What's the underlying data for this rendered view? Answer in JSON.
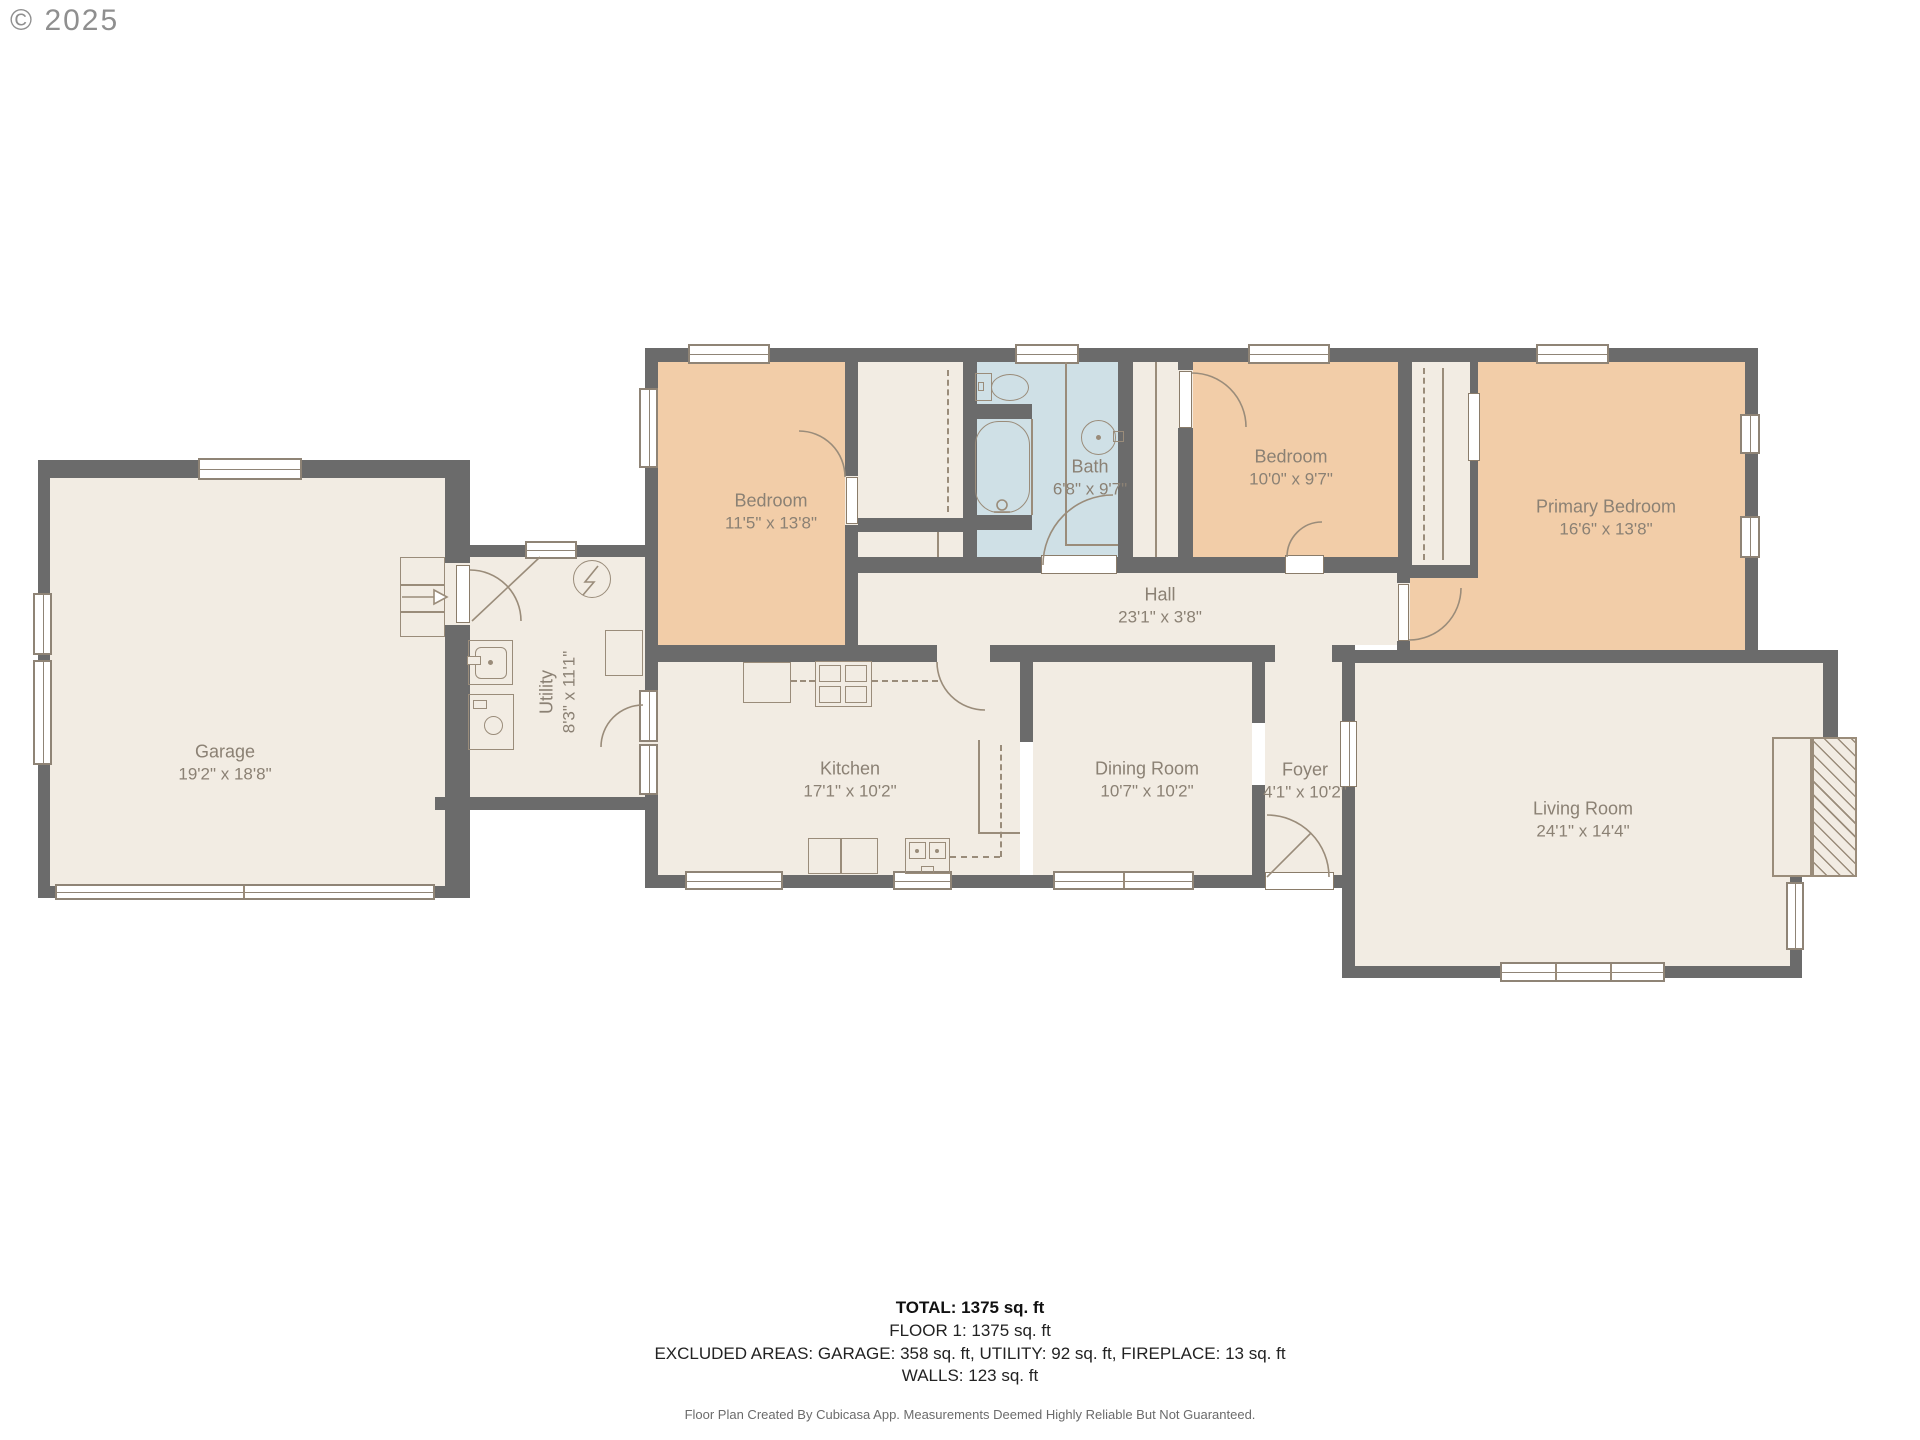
{
  "copyright": "© 2025",
  "colors": {
    "wall": "#6b6b6b",
    "floor": "#f2ece3",
    "bedroom_floor": "#f2cda8",
    "bath_floor": "#cfe0e6",
    "fixture_line": "#9a8c7a",
    "label_text": "#8b8174"
  },
  "rooms": [
    {
      "name": "Garage",
      "dims": "19'2\" x 18'8\""
    },
    {
      "name": "Utility",
      "dims": "8'3\" x 11'1\""
    },
    {
      "name": "Bedroom",
      "dims": "11'5\" x 13'8\""
    },
    {
      "name": "Bath",
      "dims": "6'8\" x 9'7\""
    },
    {
      "name": "Bedroom",
      "dims": "10'0\" x 9'7\""
    },
    {
      "name": "Primary Bedroom",
      "dims": "16'6\" x 13'8\""
    },
    {
      "name": "Hall",
      "dims": "23'1\" x 3'8\""
    },
    {
      "name": "Kitchen",
      "dims": "17'1\" x 10'2\""
    },
    {
      "name": "Dining Room",
      "dims": "10'7\" x 10'2\""
    },
    {
      "name": "Foyer",
      "dims": "4'1\" x 10'2\""
    },
    {
      "name": "Living Room",
      "dims": "24'1\" x 14'4\""
    }
  ],
  "footer": {
    "total": "TOTAL: 1375 sq. ft",
    "floor": "FLOOR 1: 1375 sq. ft",
    "excluded": "EXCLUDED AREAS: GARAGE: 358 sq. ft, UTILITY: 92 sq. ft, FIREPLACE: 13 sq. ft",
    "walls": "WALLS: 123 sq. ft",
    "credit": "Floor Plan Created By Cubicasa App. Measurements Deemed Highly Reliable But Not Guaranteed."
  }
}
